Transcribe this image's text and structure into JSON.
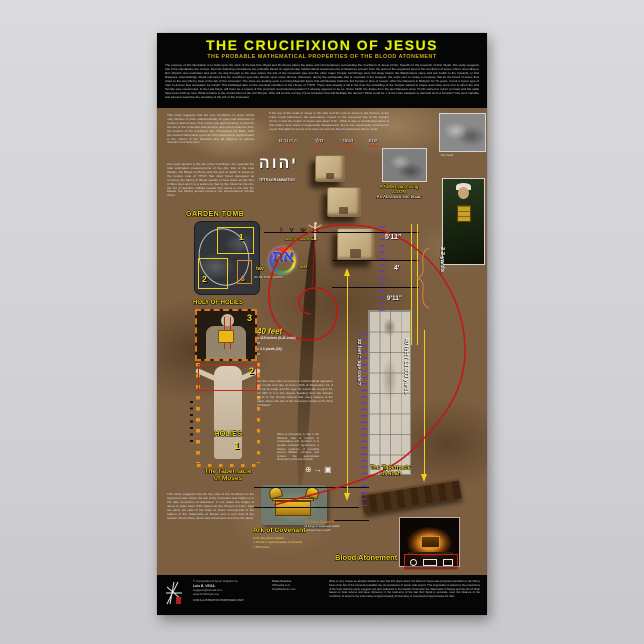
{
  "p": {
    "hdr": {
      "title": "THE CRUCIFIXION OF JESUS",
      "subtitle": "THE PROBABLE MATHEMATICAL PROPERTIES OF THE BLOOD ATONEMENT",
      "intro": "The purpose of this illustration is to build upon the work of the late Ron Wyatt and his theory about the place and circumstances surrounding the crucifixion of Jesus Christ. Specific to the research of Ron Wyatt, this study suggests that if the stipulations are correct, then the following correlations are probable based on approximate mathematical measurements of distances present from the point of the supposed spot of the crucifixion of Jesus Christ. According to Ron Wyatt's own estimates and work, he dug through to the cave where the Ark of the Covenant was and the other major Temple furnishings were hid away before the Babylonians came and led Judah to the Captivity or 2nd Diaspora. Astonishingly, Wyatt surmised that the crucifixion spot was directly upon some 40 feet. Moreover, during the earthquake that is recorded in the Gospels, the rocks rent to create a crevasse that let the blood of Jesus flow down to the very Mercy Seat of the Ark of the Covenant. The Jews are looking upon a coming Messiah figure that will likewise build the 3rd Temple in time of 'peace'. After the Diaspora in Babylon for 70 years, it took a Cyrus type of man to decree that Jerusalem be rebuilt. This facilitated later on the eventual condition of the House of YHVH. There was already a lull in the time the rebuilding of the Temple started to cease and many were torn to when the 2nd Temple was constructed. In the Last Days, will there be a repeat of this prophetic and historical pattern? It already appears to be so. Since 1948, the Exiles from the last Diaspora since 70 AD started to return to Israel and the walls have been built up now. What remains is the construction of the 3rd Temple. Who will be this coming 'Cyrus Anointed' that will facilitate the decree? What could be 1 of the main catalysts to demand such a Temple? One such variable and element would be the unveiling of the Ark of the Covenant."
    },
    "left": {
      "p1": "This study suggests that the very crucifixion of Jesus Christ may function in plots mathematically of types and distances to create a sacred ratio. One could map approximately at how far the Ark of the Covenant was and the other such evidence from the location of the crucifixion site. Throughout the Bible, both the ancient Tabernacle types do echo dimensions sophisticated to the nature of the Messiah and all degrees of various domains and dimension.",
      "p2": "One such element is the site of the Crucifixion. For example the total estimation measurements of the Ark, that of the Law Tablets, the Blood on Mercy and the spot of death of Jesus on the broken Law of YHVH that shed blood deceased as covering, the Mercy of Blood speaks of how Jesus as the Son of Man died and it is a testimony that by the blood on the Ark, the Act of Sacrifice fulfilled speaks that Jesus is not only the Master but having atoned became the blood-stained Temple vision.",
      "garden_tomb": "GARDEN TOMB",
      "n1": "1",
      "n2": "2",
      "n3": "3",
      "holy_of_holies": "HOLY OF HOLIES",
      "hoh_n": "3",
      "body_n2": "2",
      "holies": "HOLIES",
      "body_n1": "1",
      "moses1": "The Tabernacle",
      "moses2": "of Moses",
      "p3": "This study suggests that the key ratio of the crucifixion to the supposed cave where the Ark of the Covenant was hidden is in phi ratio proportion of distances. If one takes the height of Jesus to have been 5'11\" based on the Shroud of Turin, then the same phi ratio of the body of Jesus corresponds to the pattern of the Tabernacle of Moses and in turn that of the Garden Tomb where Jesus was buried and rose from the dead."
    },
    "ctr": {
      "p_top": "If the top of the head of Jesus is the side and the feet of Jesus is the fulcrum of the entire mural placement, the speculation, based on the supposed site of the Garden Tomb, is that the height of Jesus was about 5'11\". What is also a contributing factor is that hidden spot where it supposedly disappeared, Jesus was supposedly anointed on at just that platform as the rock was rent and the blood reached the Mercy Seat.",
      "inri": [
        {
          "h": "היהודים",
          "l": "JEWS"
        },
        {
          "h": "מלך",
          "l": "KING"
        },
        {
          "h": "הנצרי",
          "l": "NAZARENE"
        },
        {
          "h": "ישוע",
          "l": "JOSHUA"
        }
      ],
      "yhwh": "יהוה",
      "tetra": "TETRAGRAMMATON",
      "pictographs": "† Y Ψ Ж",
      "picto_caption": "Aleph  Tav  'Bound Hand'",
      "at": "את",
      "tav": "tav",
      "alef": "alef",
      "cross_caption": "On the Cross, Adonai",
      "m511": "5'11\"",
      "m4": "4'",
      "m911": "9'11\"",
      "yards33": "3.3 yards",
      "f40_head": "40 feet",
      "f40": [
        "= 119 inches (9-11 code)",
        "or",
        "= 3.3 yards (33)",
        "or"
      ],
      "p_did": "Did the event also record as a mathematical signature the month and day of Jesus' birth of September 11, 3 BC (9-11 code) and the age He would die on April 14, 32 AD? Is it a 112 degree heading from the Garden Tomb to the Temple Mound that many believe is the place where the Ark of the Covenant rested in the Holy of Holies?",
      "p_what": "What is interesting is that if the distance that is implied is extrapolated and prorated to a parallel prophetic significance, it follows evidence of revealing sacred Biblical numbers and echoes the approximate dimension of the Ark of Noah.",
      "symbols": "⊕ → ▣",
      "rot32": "32 feet = 'age code'?",
      "rot40": "40 feet / 13.333 yards",
      "ark_label": "Ark of Covenant",
      "ark_lines": [
        "if phi ratio factor applied",
        "= 40 feet or approximately 13.33 yards",
        "= 480 inches"
      ],
      "shroud_head": "The Flesh Shroud is",
      "shroud1": "44 Kings of Israel and Judah",
      "shroud2": "—44 feet from cross?",
      "blood": "Blood Atonement"
    },
    "rt": {
      "photo1_caption": "Ron Wyatt",
      "father1": "A Father sacrificing",
      "father2": "a SON",
      "father3": "As Abraham and Isaac",
      "noah1": "The 'Tabernacle'",
      "noah2": "of Noah"
    },
    "ftr": {
      "credit": "© Composition & Some Graphics by",
      "name": "Luis B. VEGA",
      "email": "vegapost@hotmail.com",
      "site": "www.PostScripts.org",
      "purpose": "FOR ILLUSTRATION PURPOSES ONLY",
      "sources_t": "Some Sources",
      "s1": "Wikipedia.com",
      "s2": "WyattMuseum.com",
      "note": "What is very unique as already alluded to was that this place where the blood of Jesus was purported sprinkled on the Mercy Seat of the Ark of the Covenant parallels the circumstances of Jesus' side wound. This supposition is based on the proportions of the body that this study suggests are also patterned in the Garden Tomb after the Tabernacle of Moses and the Ark of Noah based on total volume and area. Moreover, if the testimony of the late Ron Wyatt is accurate, even the distance of the crucifixion of Jesus to the cave below of approximately 40 feet deep is composed of approximate phi ratio."
    }
  }
}
